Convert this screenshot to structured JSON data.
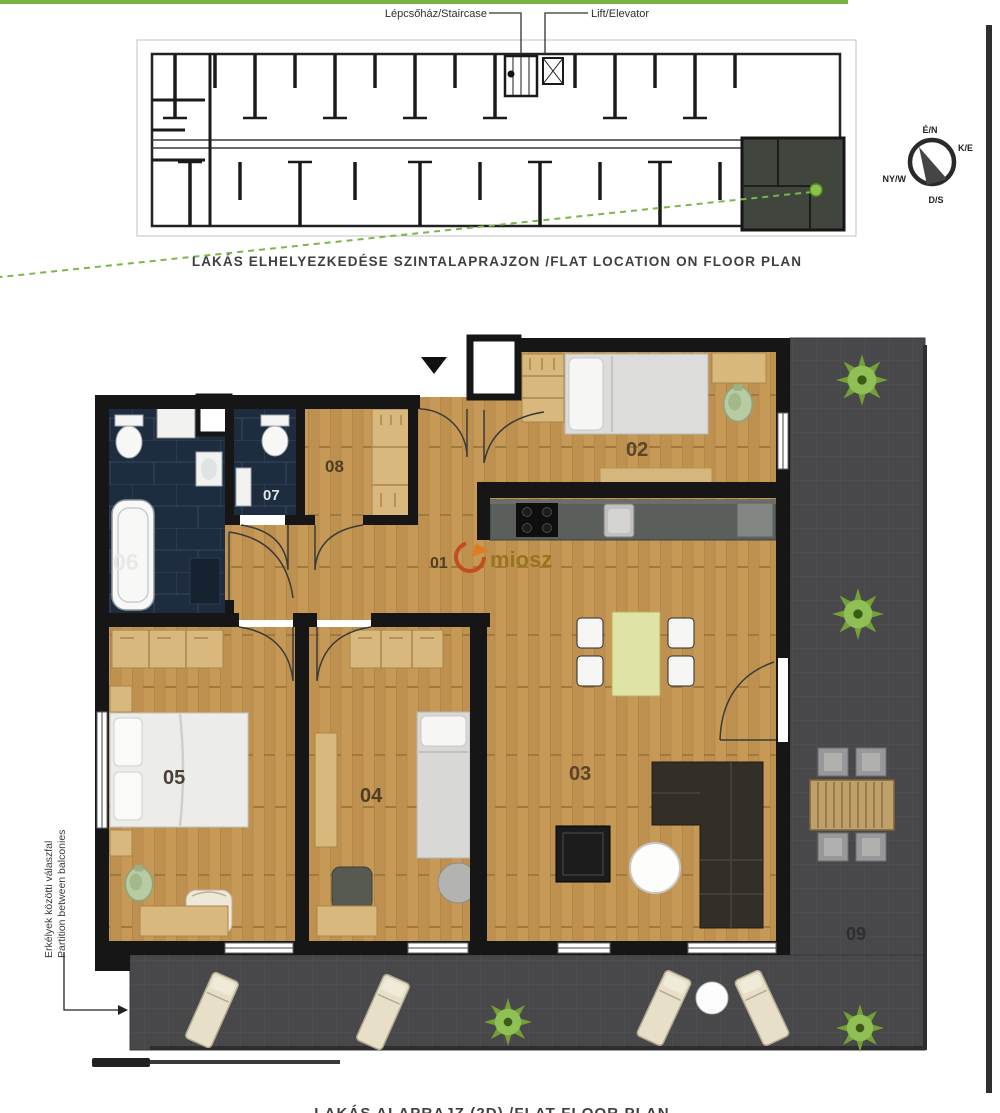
{
  "page": {
    "top_caption": "LAKÁS ELHELYEZKEDÉSE SZINTALAPRAJZON /FLAT LOCATION ON FLOOR PLAN",
    "bottom_caption": "LAKÁS ALAPRAJZ (2D) /FLAT FLOOR PLAN"
  },
  "overview": {
    "staircase_label": "Lépcsőház/Staircase",
    "lift_label": "Lift/Elevator",
    "highlight_color": "#40453e",
    "marker_color": "#7ab648"
  },
  "compass": {
    "n": "É/N",
    "e": "K/E",
    "s": "D/S",
    "w": "NY/W"
  },
  "rooms": [
    {
      "label": "01"
    },
    {
      "label": "02"
    },
    {
      "label": "03"
    },
    {
      "label": "04"
    },
    {
      "label": "05"
    },
    {
      "label": "06"
    },
    {
      "label": "07"
    },
    {
      "label": "08"
    },
    {
      "label": "09"
    }
  ],
  "annotation": {
    "line1": "Erkélyek közötti válaszfal",
    "line2": "Partition between balconies"
  },
  "watermark": {
    "text": "miosz"
  },
  "colors": {
    "wood": "#c69a56",
    "tile": "#1d2c3e",
    "terrace": "#48484b",
    "wall": "#161616",
    "accent_green": "#7ab648",
    "watermark_orange": "#c44a1d",
    "watermark_text": "#96731d"
  }
}
